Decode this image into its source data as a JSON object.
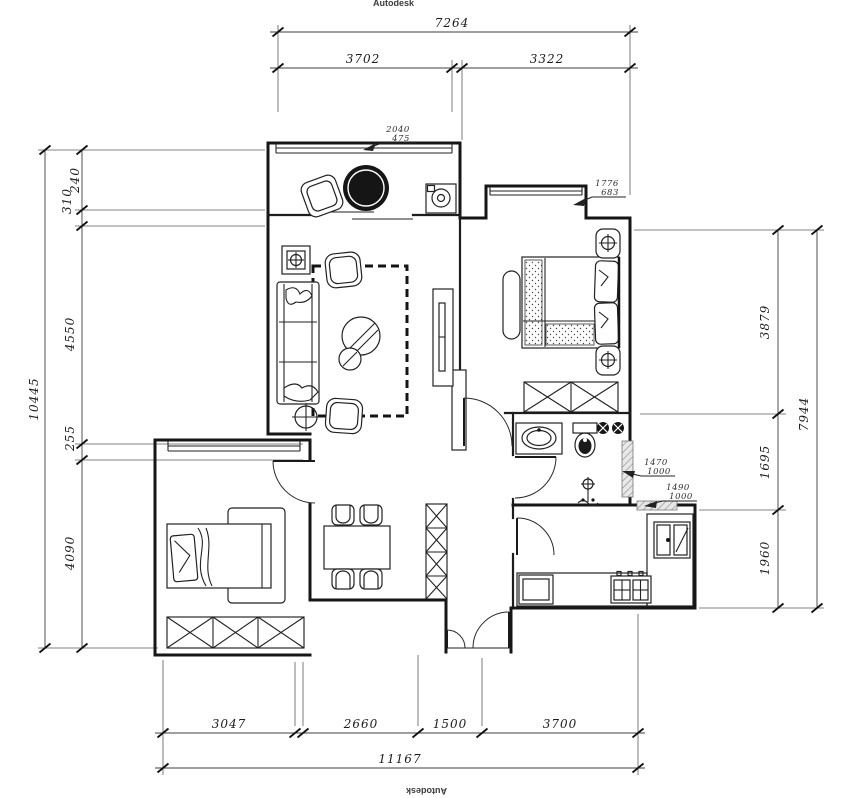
{
  "watermarks": {
    "top": "Autodesk",
    "bottom": "Autodesk"
  },
  "dimensions": {
    "top": {
      "total": "7264",
      "segments": [
        "3702",
        "3322"
      ]
    },
    "left": {
      "total": "10445",
      "segments": [
        "310",
        "240",
        "4550",
        "255",
        "4090"
      ]
    },
    "right": {
      "total": "7944",
      "segments": [
        "3879",
        "1695",
        "1960"
      ]
    },
    "bottom": {
      "total": "11167",
      "segments": [
        "3047",
        "2660",
        "1500",
        "3700"
      ]
    }
  },
  "window_tags": [
    {
      "width": "2040",
      "height": "475"
    },
    {
      "width": "1776",
      "height": "683"
    },
    {
      "width": "1470",
      "height": "1000"
    },
    {
      "width": "1490",
      "height": "1000"
    }
  ]
}
